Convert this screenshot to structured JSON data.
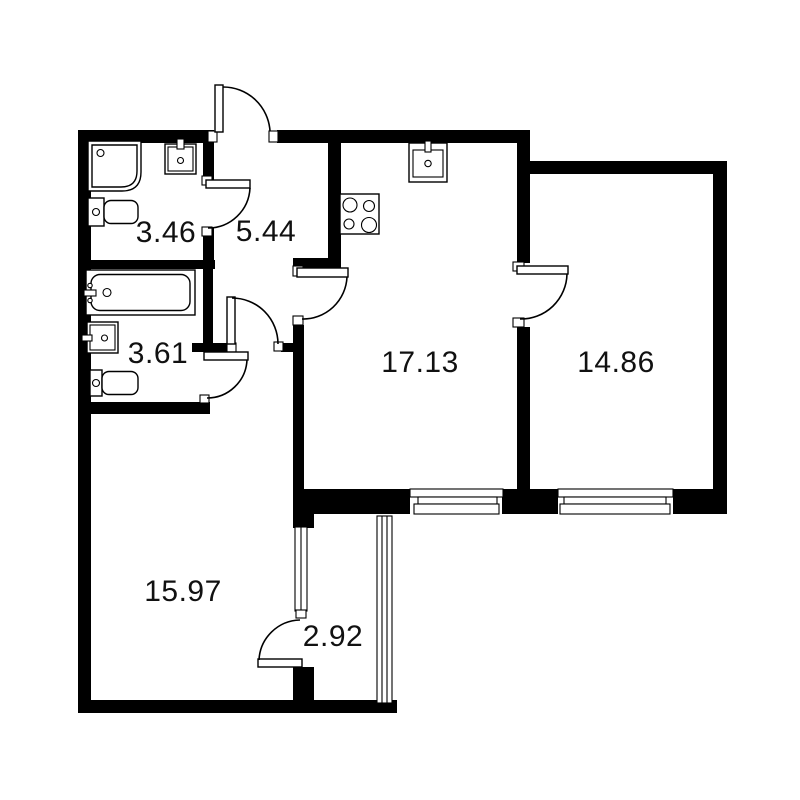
{
  "colors": {
    "background": "#ffffff",
    "walls": "#000000",
    "lines": "#000000",
    "text": "#111111"
  },
  "rooms": [
    {
      "name": "bathroom-shower",
      "area": "3.46"
    },
    {
      "name": "hallway",
      "area": "5.44"
    },
    {
      "name": "bathroom-tub",
      "area": "3.61"
    },
    {
      "name": "kitchen",
      "area": "17.13"
    },
    {
      "name": "bedroom",
      "area": "14.86"
    },
    {
      "name": "living-room",
      "area": "15.97"
    },
    {
      "name": "balcony",
      "area": "2.92"
    }
  ]
}
